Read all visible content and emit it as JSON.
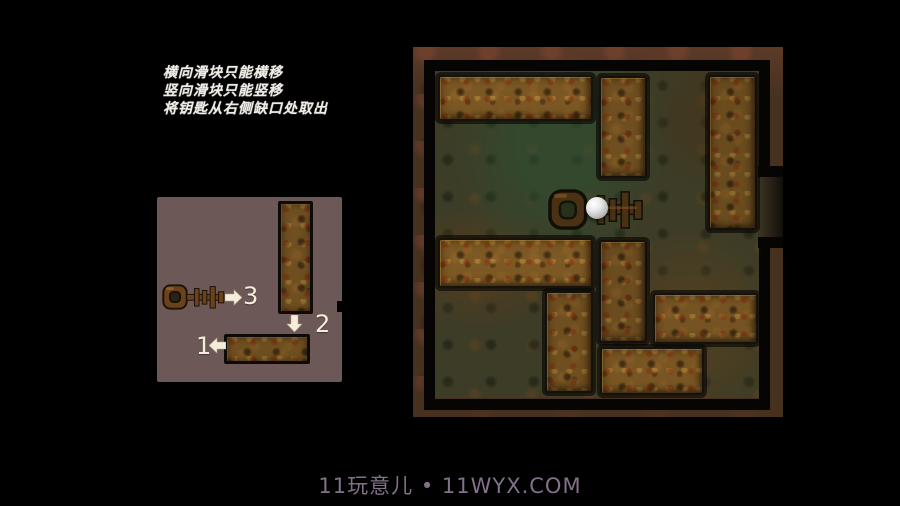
{
  "instructions": {
    "lines": [
      "横向滑块只能横移",
      "竖向滑块只能竖移",
      "将钥匙从右侧缺口处取出"
    ],
    "text_color": "#efece6"
  },
  "diagram": {
    "description_blocks": [
      "vertical-slider",
      "horizontal-slider",
      "key"
    ],
    "panel_color": "#6c5957",
    "steps": [
      {
        "label": "1",
        "direction": "left"
      },
      {
        "label": "2",
        "direction": "down"
      },
      {
        "label": "3",
        "direction": "right"
      }
    ]
  },
  "board": {
    "frame_color": "#46311f",
    "interior_color": "#3d3c26",
    "wall_color": "#060504",
    "grid": {
      "cols": 6,
      "rows": 6
    },
    "blocks": [
      {
        "id": "top-left-horizontal",
        "orient": "horizontal",
        "col": 0,
        "row": 0,
        "span": 3,
        "x": 25,
        "y": 28,
        "w": 155,
        "h": 46,
        "tone": 1.1
      },
      {
        "id": "top-middle-vertical",
        "orient": "vertical",
        "col": 3,
        "row": 0,
        "span": 2,
        "x": 186,
        "y": 29,
        "w": 48,
        "h": 102,
        "tone": 1.0
      },
      {
        "id": "top-right-vertical",
        "orient": "vertical",
        "col": 5,
        "row": 0,
        "span": 3,
        "x": 295,
        "y": 28,
        "w": 49,
        "h": 155,
        "tone": 0.95
      },
      {
        "id": "middle-left-horizontal",
        "orient": "horizontal",
        "col": 0,
        "row": 3,
        "span": 3,
        "x": 25,
        "y": 191,
        "w": 155,
        "h": 50,
        "tone": 1.12
      },
      {
        "id": "center-left-vertical",
        "orient": "vertical",
        "col": 2,
        "row": 4,
        "span": 2,
        "x": 132,
        "y": 244,
        "w": 48,
        "h": 102,
        "tone": 1.0
      },
      {
        "id": "center-vertical",
        "orient": "vertical",
        "col": 3,
        "row": 3,
        "span": 2,
        "x": 186,
        "y": 193,
        "w": 48,
        "h": 103,
        "tone": 0.96
      },
      {
        "id": "middle-right-horizontal",
        "orient": "horizontal",
        "col": 4,
        "row": 4,
        "span": 2,
        "x": 240,
        "y": 246,
        "w": 105,
        "h": 51,
        "tone": 1.05
      },
      {
        "id": "bottom-center-horizontal",
        "orient": "horizontal",
        "col": 3,
        "row": 5,
        "span": 2,
        "x": 187,
        "y": 300,
        "w": 104,
        "h": 48,
        "tone": 1.08
      }
    ],
    "key": {
      "x": 135,
      "y": 141,
      "w": 99,
      "h": 43,
      "row": 2
    },
    "ball": {
      "x": 173,
      "y": 150,
      "size": 22
    },
    "notch": {
      "side": "right",
      "x": 345,
      "y": 119,
      "w": 25,
      "h": 82
    }
  },
  "watermark": {
    "text": "11玩意儿 • 11WYX.COM",
    "color": "#837089"
  }
}
